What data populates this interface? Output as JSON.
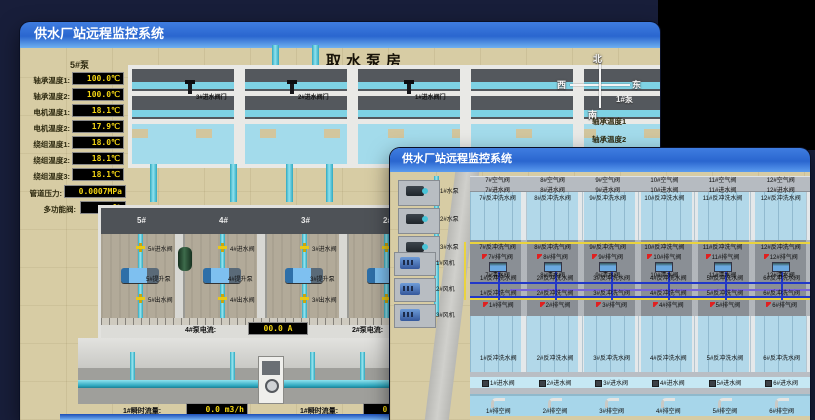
{
  "back_window": {
    "title": "供水厂站远程监控系统",
    "scene_title": "取水泵房",
    "pump_panel": {
      "header": "5#泵",
      "rows": [
        {
          "label": "轴承温度1:",
          "value": "100.0℃"
        },
        {
          "label": "轴承温度2:",
          "value": "100.0℃"
        },
        {
          "label": "电机温度1:",
          "value": "18.1℃"
        },
        {
          "label": "电机温度2:",
          "value": "17.9℃"
        },
        {
          "label": "绕组温度1:",
          "value": "18.0℃"
        },
        {
          "label": "绕组温度2:",
          "value": "18.1℃"
        },
        {
          "label": "绕组温度3:",
          "value": "18.1℃"
        },
        {
          "label": "管道压力:",
          "value": "0.0007MPa"
        },
        {
          "label": "多功能阀:",
          "value": "0%"
        }
      ]
    },
    "intake_valves": [
      "3#进水阀门",
      "2#进水阀门",
      "1#进水阀门"
    ],
    "compass": {
      "north": "北",
      "west": "西",
      "south": "南",
      "east": "东"
    },
    "right_panel": {
      "header": "1#泵",
      "labels": [
        "轴承温度1",
        "轴承温度2"
      ]
    },
    "bays": [
      {
        "no": "5#",
        "inlet": "5#进水阀",
        "pump": "5#提升泵",
        "outlet": "5#出水阀"
      },
      {
        "no": "4#",
        "inlet": "4#进水阀",
        "pump": "4#提升泵",
        "outlet": "4#出水阀"
      },
      {
        "no": "3#",
        "inlet": "3#进水阀",
        "pump": "3#提升泵",
        "outlet": "3#出水阀"
      },
      {
        "no": "2#",
        "inlet": "2#进水阀",
        "pump": "2#提升泵",
        "outlet": "2#出水阀"
      }
    ],
    "current_readouts": [
      {
        "label": "4#泵电流:",
        "value": "00.0 A"
      },
      {
        "label": "2#泵电流:",
        "value": ""
      }
    ],
    "flow_readouts": [
      {
        "label": "1#瞬时流量:",
        "value": "0.0 m3/h"
      },
      {
        "label": "1#瞬时流量:",
        "value": "0.0 m3/h"
      }
    ]
  },
  "front_window": {
    "title": "供水厂站远程监控系统",
    "scene_title": "1#V滤池",
    "equipment": {
      "pumps": [
        "1#水泵",
        "2#水泵",
        "3#水泵"
      ],
      "blowers": [
        "1#风机",
        "2#风机",
        "3#风机"
      ]
    },
    "grid": {
      "air_top": [
        "7#空气阀",
        "8#空气阀",
        "9#空气阀",
        "10#空气阀",
        "11#空气阀",
        "12#空气阀"
      ],
      "inlet_top": [
        "7#进水阀",
        "8#进水阀",
        "9#进水阀",
        "10#进水阀",
        "11#进水阀",
        "12#进水阀"
      ],
      "backwash_water_top": [
        "7#反冲洗水阀",
        "8#反冲洗水阀",
        "9#反冲洗水阀",
        "10#反冲洗水阀",
        "11#反冲洗水阀",
        "12#反冲洗水阀"
      ],
      "backwash_air_top": [
        "7#反冲洗气阀",
        "8#反冲洗气阀",
        "9#反冲洗气阀",
        "10#反冲洗气阀",
        "11#反冲洗气阀",
        "12#反冲洗气阀"
      ],
      "exhaust_top": [
        "7#排气阀",
        "8#排气阀",
        "9#排气阀",
        "10#排气阀",
        "11#排气阀",
        "12#排气阀"
      ],
      "clean_top": [
        "7#清水阀",
        "8#清水阀",
        "9#清水阀",
        "10#清水阀",
        "11#清水阀",
        "12#清水阀"
      ],
      "backwash_water_mid": [
        "1#反冲洗水阀",
        "2#反冲洗水阀",
        "3#反冲洗水阀",
        "4#反冲洗水阀",
        "5#反冲洗水阀",
        "6#反冲洗水阀"
      ],
      "backwash_air_bottom": [
        "1#反冲洗气阀",
        "2#反冲洗气阀",
        "3#反冲洗气阀",
        "4#反冲洗气阀",
        "5#反冲洗气阀",
        "6#反冲洗气阀"
      ],
      "exhaust_bottom": [
        "1#排气阀",
        "2#排气阀",
        "3#排气阀",
        "4#排气阀",
        "5#排气阀",
        "6#排气阀"
      ],
      "backwash_water_pool": [
        "1#反冲洗水阀",
        "2#反冲洗水阀",
        "3#反冲洗水阀",
        "4#反冲洗水阀",
        "5#反冲洗水阀",
        "6#反冲洗水阀"
      ],
      "inlet_bottom": [
        "1#进水阀",
        "2#进水阀",
        "3#进水阀",
        "4#进水阀",
        "5#进水阀",
        "6#进水阀"
      ],
      "drain_bottom": [
        "1#排空阀",
        "2#排空阀",
        "3#排空阀",
        "4#排空阀",
        "5#排空阀",
        "6#排空阀"
      ]
    }
  }
}
